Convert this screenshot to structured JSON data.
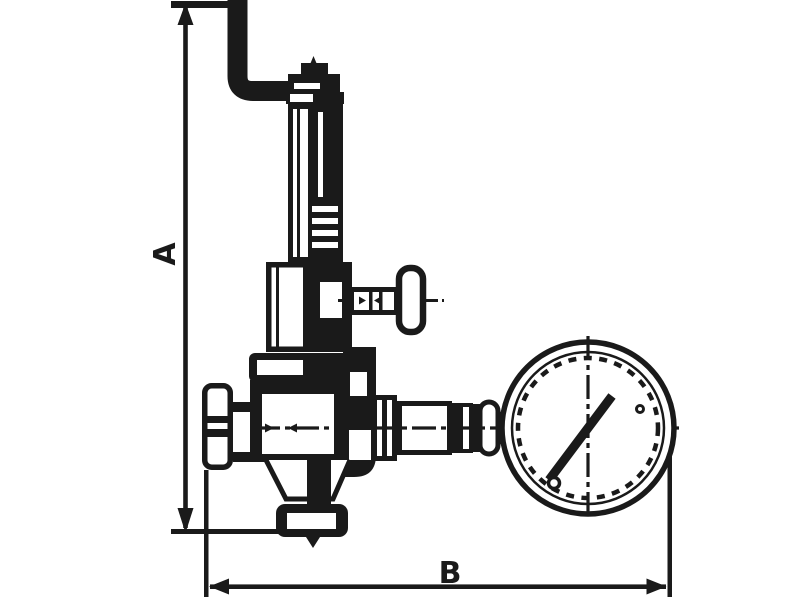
{
  "drawing": {
    "background_color": "#ffffff",
    "line_color": "#1a1a1a",
    "dimension_a": {
      "label": "A",
      "orientation": "vertical"
    },
    "dimension_b": {
      "label": "B",
      "orientation": "horizontal"
    },
    "components": [
      "inlet-pipe-elbow",
      "bonnet-cap",
      "spring-bonnet",
      "spring-housing",
      "adjustment-t-handle",
      "valve-body",
      "inlet-fitting",
      "outlet-flange",
      "gauge-connection-fittings",
      "pressure-gauge",
      "gauge-needle"
    ]
  }
}
